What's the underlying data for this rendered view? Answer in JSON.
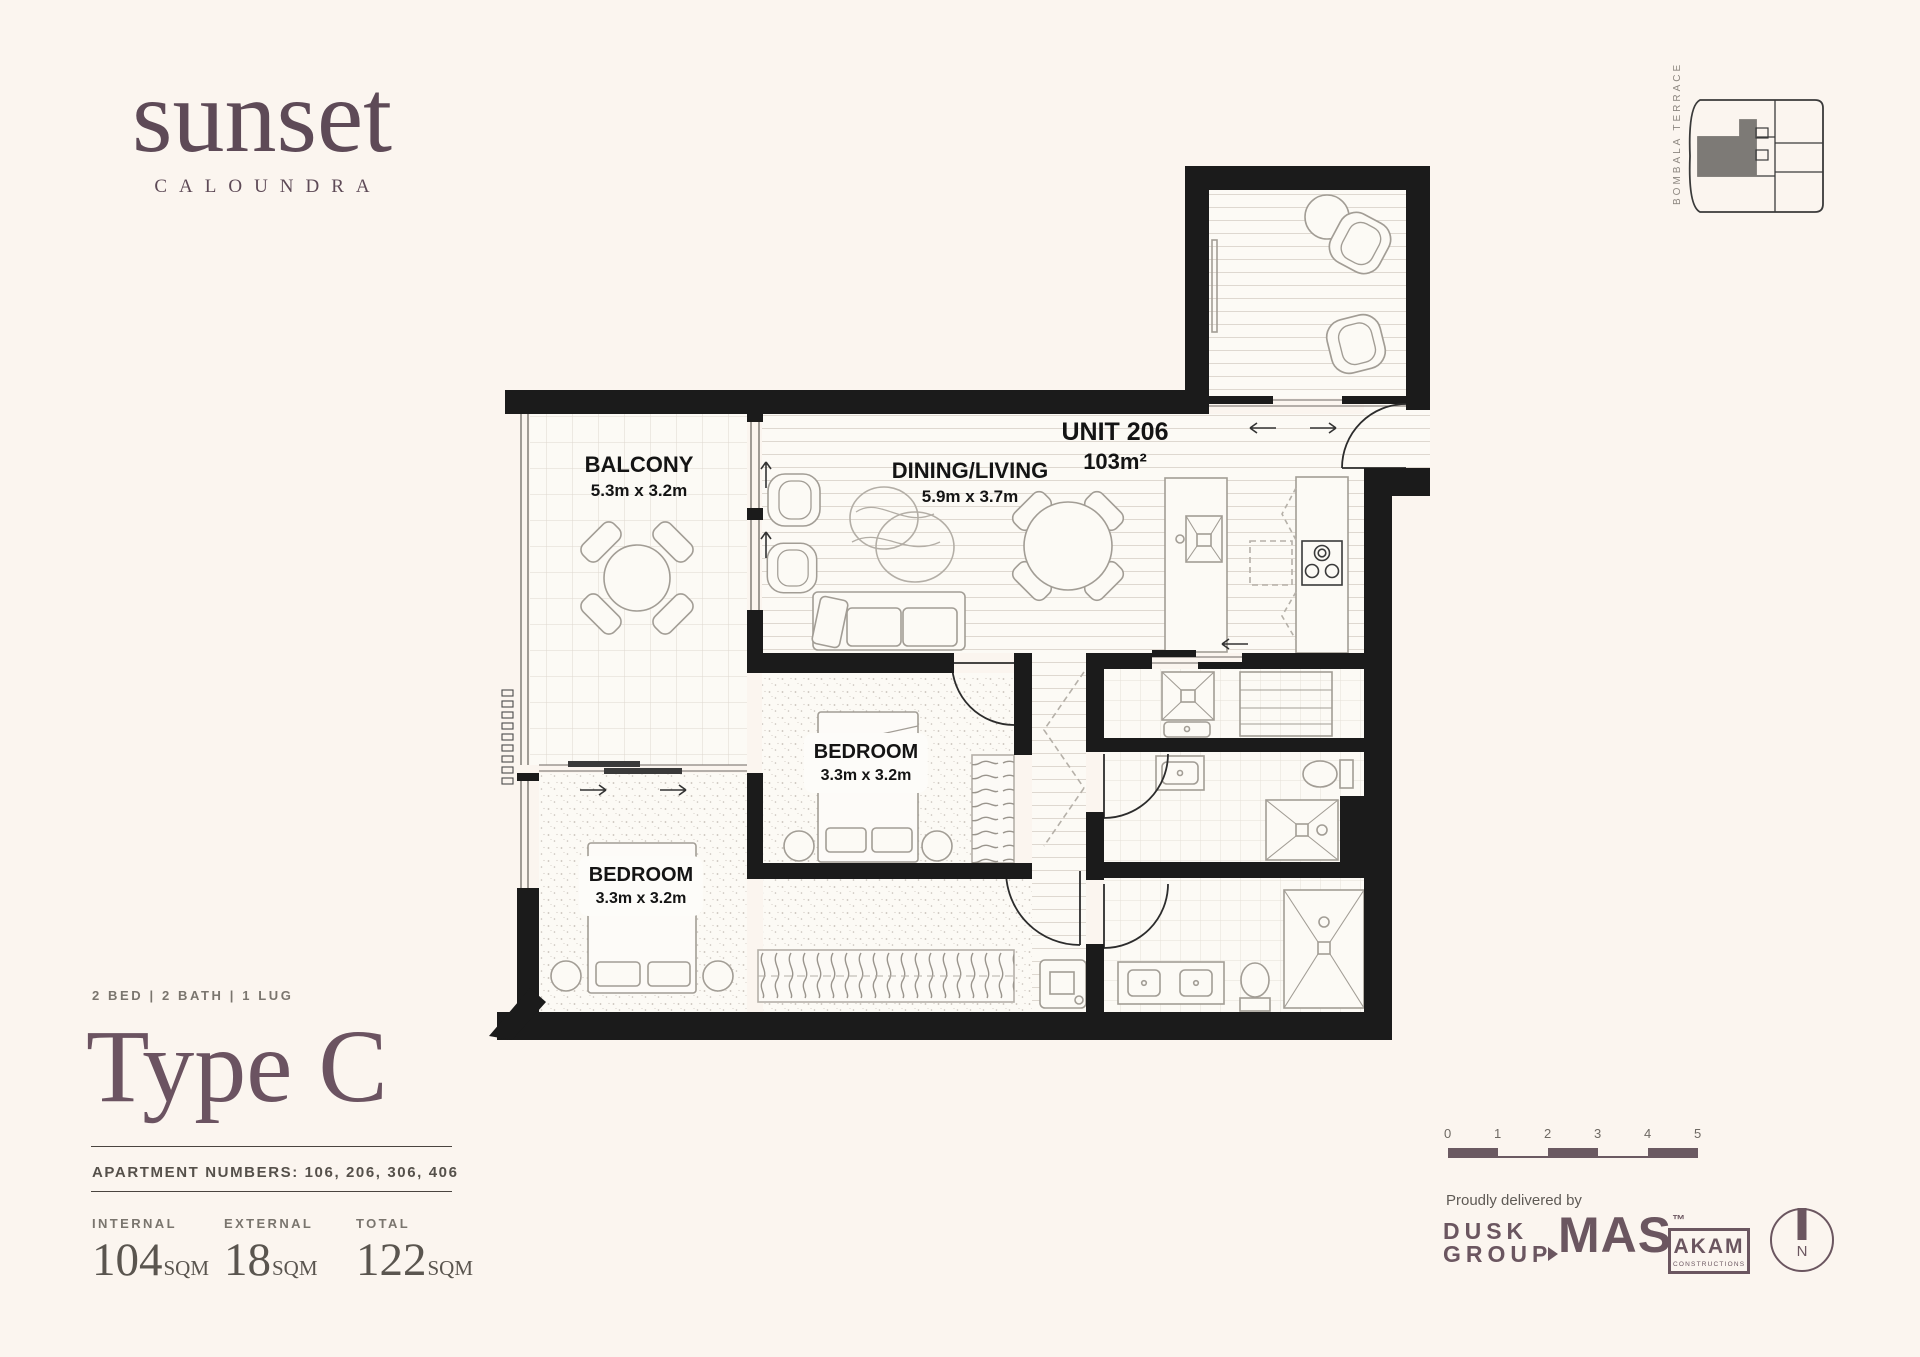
{
  "brand": {
    "name": "sunset",
    "location": "CALOUNDRA"
  },
  "keyplan": {
    "street_label": "BOMBALA TERRACE"
  },
  "plan": {
    "unit_name": "UNIT 206",
    "unit_area": "103m²",
    "balcony": {
      "name": "BALCONY",
      "dims": "5.3m x 3.2m"
    },
    "dining": {
      "name": "DINING/LIVING",
      "dims": "5.9m x 3.7m"
    },
    "bedroom1": {
      "name": "BEDROOM",
      "dims": "3.3m x 3.2m"
    },
    "bedroom2": {
      "name": "BEDROOM",
      "dims": "3.3m x 3.2m"
    }
  },
  "details": {
    "config": "2 BED | 2 BATH | 1 LUG",
    "type_name": "Type C",
    "apartments": "APARTMENT NUMBERS: 106, 206, 306, 406",
    "stats": [
      {
        "label": "INTERNAL",
        "value": "104",
        "unit": "SQM"
      },
      {
        "label": "EXTERNAL",
        "value": "18",
        "unit": "SQM"
      },
      {
        "label": "TOTAL",
        "value": "122",
        "unit": "SQM"
      }
    ]
  },
  "footer": {
    "scale_ticks": [
      "0",
      "1",
      "2",
      "3",
      "4",
      "5"
    ],
    "delivered_by": "Proudly delivered by",
    "partners": {
      "dusk": {
        "line1": "DUSK",
        "line2": "GROUP"
      },
      "mas": {
        "name": "MAS",
        "tm": "™"
      },
      "akam": {
        "name": "AKAM",
        "sub": "CONSTRUCTIONS"
      }
    },
    "north": "N"
  },
  "colors": {
    "brand_plum": "#6B5561",
    "background": "#FBF5EF",
    "wall": "#1B1B1B"
  }
}
